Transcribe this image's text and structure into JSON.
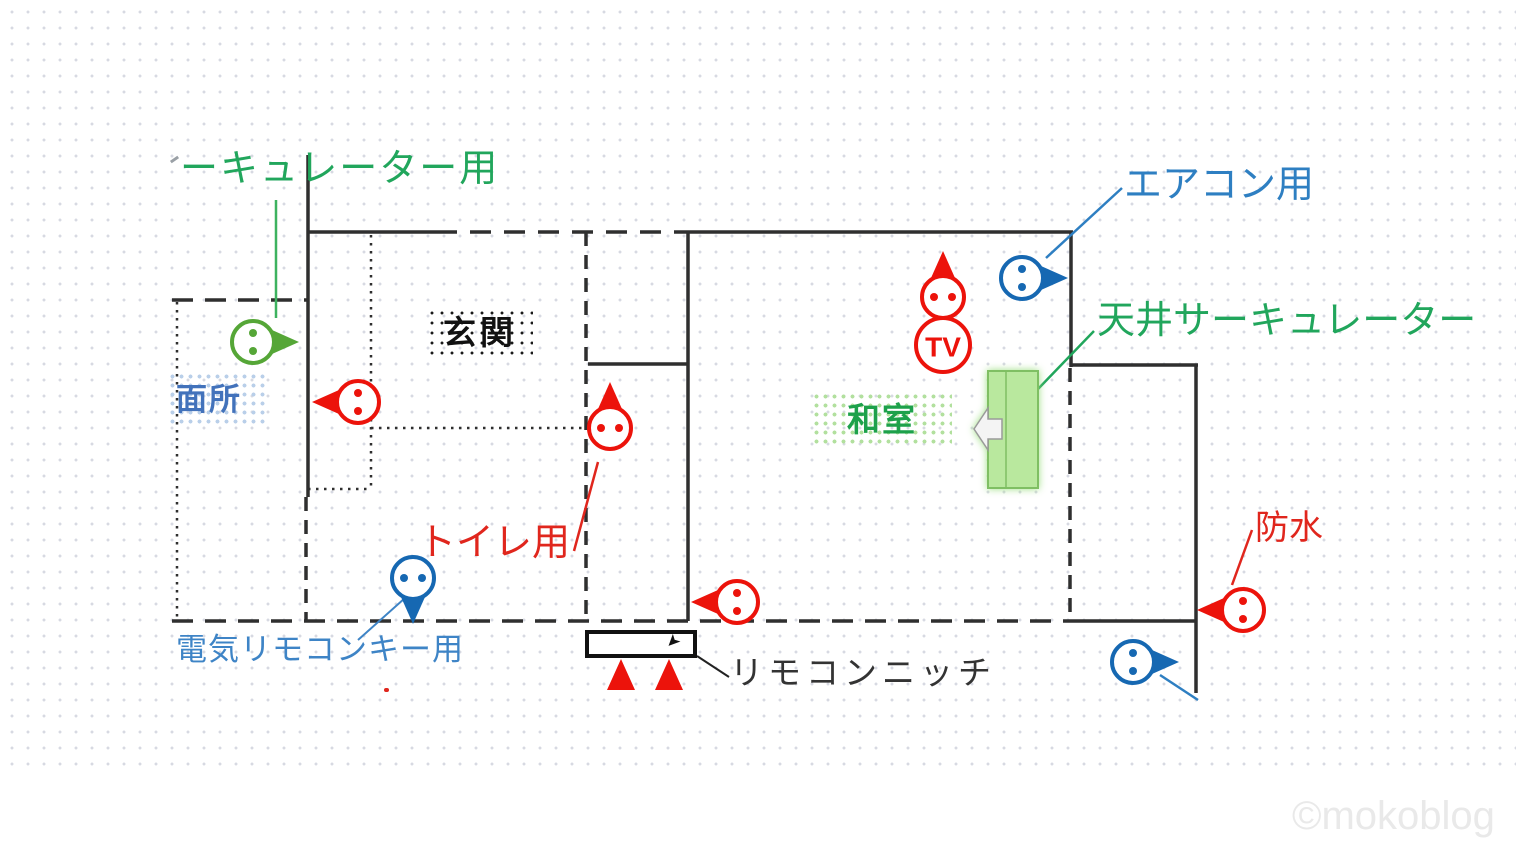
{
  "labels": {
    "circulator_partial": "ーキュレーター用",
    "aircon": "エアコン用",
    "ceiling_circulator": "天井サーキュレーター",
    "entrance": "玄関",
    "washroom_partial": "面所",
    "japanese_room": "和室",
    "toilet": "トイレ用",
    "electric_remote_key": "電気リモコンキー用",
    "remote_niche": "リモコンニッチ",
    "waterproof": "防水",
    "tv": "TV",
    "watermark": "©mokoblog",
    "cursor_glyph": "➤"
  },
  "colors": {
    "green": "#55a637",
    "red": "#ec130b",
    "blue": "#1668b2",
    "label_green": "#21a65c",
    "label_blue": "#2e7fc2",
    "label_red": "#e0261d",
    "wall": "#2f2f2f",
    "greenbox_fill": "#b9e89e",
    "greenbox_border": "#7fbf63"
  },
  "outlets": [
    {
      "name": "circulator",
      "color": "green",
      "dir": "right",
      "x": 253,
      "y": 342
    },
    {
      "name": "washroom",
      "color": "red",
      "dir": "left",
      "x": 358,
      "y": 402
    },
    {
      "name": "toilet",
      "color": "red",
      "dir": "up",
      "x": 610,
      "y": 428
    },
    {
      "name": "electric-remote-key",
      "color": "blue",
      "dir": "down",
      "x": 413,
      "y": 578
    },
    {
      "name": "tv",
      "color": "red",
      "dir": "up",
      "x": 943,
      "y": 297
    },
    {
      "name": "aircon",
      "color": "blue",
      "dir": "right",
      "x": 1022,
      "y": 278
    },
    {
      "name": "hallway",
      "color": "red",
      "dir": "left",
      "x": 737,
      "y": 602
    },
    {
      "name": "waterproof",
      "color": "red",
      "dir": "left",
      "x": 1243,
      "y": 610
    },
    {
      "name": "bottom-right",
      "color": "blue",
      "dir": "right",
      "x": 1133,
      "y": 662
    }
  ]
}
